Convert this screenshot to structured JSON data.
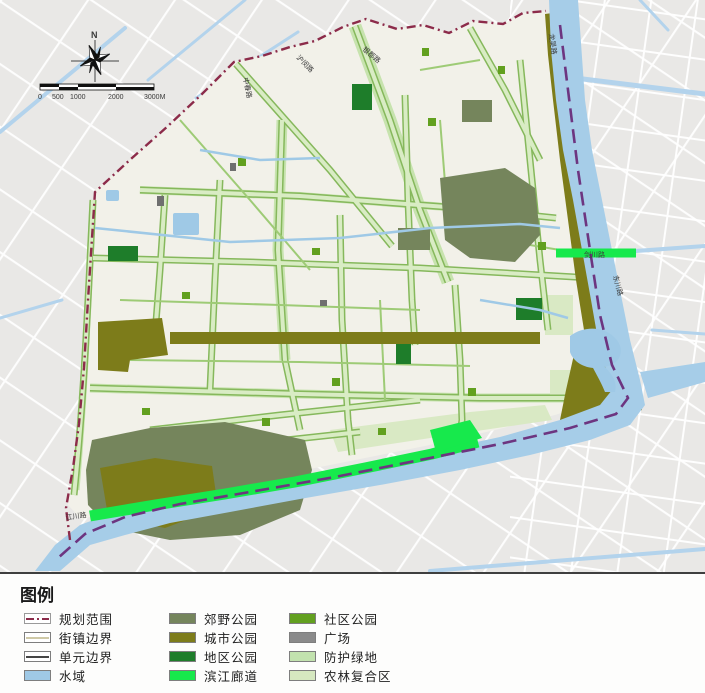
{
  "map": {
    "north_label": "N",
    "scale_bar": {
      "ticks": [
        "0",
        "500",
        "1000",
        "2000",
        "3000M"
      ]
    },
    "road_labels": [
      {
        "id": "humin-road",
        "text": "沪闵路"
      },
      {
        "id": "yindu-road",
        "text": "银都路"
      },
      {
        "id": "zhongchun-road",
        "text": "中春路"
      },
      {
        "id": "longwu-road",
        "text": "龙吴路"
      },
      {
        "id": "jianchuan-road",
        "text": "剑川路"
      },
      {
        "id": "dongchuan-road",
        "text": "东川路"
      },
      {
        "id": "jiangchuan-road",
        "text": "江川路"
      }
    ],
    "colors": {
      "outside_bg": "#e9e8e6",
      "plan_area_fill": "#f2f1e9",
      "boundary_line": "#8c2b4a",
      "river_boundary_line": "#6d3580",
      "river": "#a6cde8"
    }
  },
  "legend": {
    "title": "图例",
    "columns": [
      [
        {
          "label": "规划范围",
          "swatch": "dashed-boundary-line"
        },
        {
          "label": "街镇边界",
          "swatch": "tan-line"
        },
        {
          "label": "单元边界",
          "swatch": "dark-line"
        },
        {
          "label": "水域",
          "swatch": "fill",
          "color": "#9fc9e6"
        }
      ],
      [
        {
          "label": "郊野公园",
          "swatch": "fill",
          "color": "#75855c"
        },
        {
          "label": "城市公园",
          "swatch": "fill",
          "color": "#7d7c1a"
        },
        {
          "label": "地区公园",
          "swatch": "fill",
          "color": "#1e7d2a"
        },
        {
          "label": "滨江廊道",
          "swatch": "fill",
          "color": "#17e94c"
        }
      ],
      [
        {
          "label": "社区公园",
          "swatch": "fill",
          "color": "#62a01f"
        },
        {
          "label": "广场",
          "swatch": "fill",
          "color": "#8a8a8a"
        },
        {
          "label": "防护绿地",
          "swatch": "fill",
          "color": "#c2e2ae"
        },
        {
          "label": "农林复合区",
          "swatch": "fill",
          "color": "#d6e8c0"
        }
      ]
    ]
  }
}
